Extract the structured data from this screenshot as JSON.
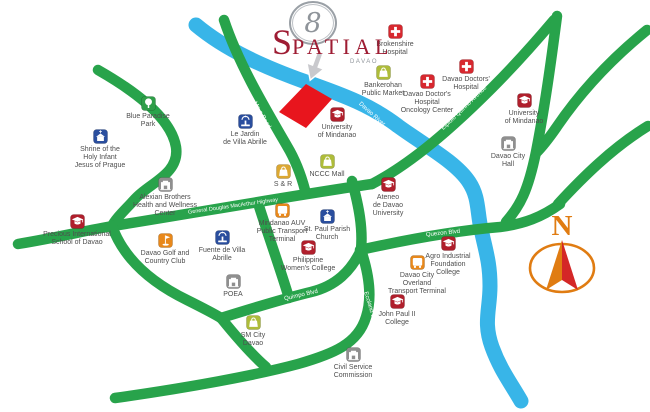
{
  "logo": {
    "mark": "8",
    "name_initial": "S",
    "name_rest": "PATIAL",
    "subtitle": "DAVAO"
  },
  "compass": {
    "north_label": "N"
  },
  "map": {
    "palette": {
      "hospital": "#d7282f",
      "school": "#b01f2c",
      "market": "#aebc3a",
      "sr": "#dca832",
      "park": "#2f9e49",
      "blue": "#2a4e9e",
      "orange": "#e8881b",
      "gov": "#8f8f8f",
      "brand_maroon": "#9e1c33",
      "logo_gray": "#8f949a",
      "compass_orange": "#e07c12",
      "compass_red": "#d42727",
      "pointer_gray": "#c9c9cd"
    },
    "colors": {
      "road": "#28a34b",
      "river": "#38b5e8",
      "site": "#e8151d",
      "road_label": "#ffffff",
      "label_text": "#4e4e4e",
      "background": "#ffffff"
    },
    "river": {
      "name": "Davao River",
      "path": "M 196,25 C 226,50 264,67 306,82 C 346,96 372,106 398,126 C 424,145 456,162 469,182 C 479,197 477,211 481,229 C 486,252 490,263 490,286 C 490,310 483,322 492,347 C 500,369 510,382 521,401"
    },
    "roads": [
      {
        "id": "left-hill-road",
        "path": "M 98,70 C 133,90 171,117 176,147 C 180,174 149,183 135,199 C 125,210 116,218 112,226"
      },
      {
        "id": "macarthur-highway",
        "path": "M 18,244 C 60,237 88,230 113,226 C 200,212 290,196 372,184"
      },
      {
        "id": "maa-road",
        "path": "M 224,20 C 238,62 262,103 287,146 C 296,161 301,175 305,190"
      },
      {
        "id": "elpidio-quirino-avenue",
        "path": "M 372,184 C 412,163 452,128 492,88 C 512,68 532,46 554,20"
      },
      {
        "id": "bajada-road",
        "path": "M 557,16 C 551,62 545,106 536,152 C 528,191 520,206 506,222"
      },
      {
        "id": "topright-corner-road",
        "path": "M 647,30 C 610,60 579,94 556,128 C 549,138 542,147 536,153"
      },
      {
        "id": "right-edge-road",
        "path": "M 648,126 C 612,148 582,178 558,204"
      },
      {
        "id": "quezon-blvd",
        "path": "M 360,250 C 405,240 452,231 500,227 C 524,224 542,217 560,204"
      },
      {
        "id": "ecoland-upper",
        "path": "M 352,181 C 359,207 363,228 361,250"
      },
      {
        "id": "quimpo-blvd-west",
        "path": "M 112,226 C 123,257 148,281 187,300 C 203,308 213,313 221,318"
      },
      {
        "id": "quimpo-blvd-east",
        "path": "M 221,318 C 250,309 282,299 311,292 C 336,286 351,271 361,250"
      },
      {
        "id": "sm-access-road",
        "path": "M 221,318 C 238,339 252,355 266,367"
      },
      {
        "id": "villa-abrille-road",
        "path": "M 258,203 C 268,235 280,268 289,298"
      },
      {
        "id": "ecoland-drive",
        "path": "M 361,250 C 370,277 372,299 366,317 C 358,344 333,354 298,364 C 257,375 187,388 115,398"
      }
    ],
    "road_labels": [
      {
        "text": "Ma-a Road",
        "x": 262,
        "y": 115,
        "rotate": 60
      },
      {
        "text": "General Douglas MacArthur Highway",
        "x": 233,
        "y": 206,
        "rotate": -8,
        "size": 5.5
      },
      {
        "text": "Davao River",
        "x": 372,
        "y": 114,
        "rotate": 42
      },
      {
        "text": "Elpidio Quirino Avenue",
        "x": 464,
        "y": 108,
        "rotate": -44
      },
      {
        "text": "Quezon Blvd",
        "x": 443,
        "y": 233,
        "rotate": -6
      },
      {
        "text": "Quimpo Blvd",
        "x": 139,
        "y": 282,
        "rotate": 47
      },
      {
        "text": "Quimpo Blvd",
        "x": 301,
        "y": 295,
        "rotate": -13
      },
      {
        "text": "Ecoland Dr",
        "x": 370,
        "y": 306,
        "rotate": 73
      }
    ],
    "site": {
      "name": "8 Spatial site",
      "polygon": "279,112 306,84 332,99 306,128"
    },
    "landmarks": [
      {
        "id": "brokenshire-hospital",
        "icon": "cross",
        "color": "hospital",
        "cx": 395,
        "cy": 31,
        "label": [
          "Brokenshire",
          "Hospital"
        ]
      },
      {
        "id": "bankerohan-public-market",
        "icon": "bag",
        "color": "market",
        "cx": 383,
        "cy": 72,
        "label": [
          "Bankerohan",
          "Public Market"
        ]
      },
      {
        "id": "davao-doctors-hospital",
        "icon": "cross",
        "color": "hospital",
        "cx": 466,
        "cy": 66,
        "label": [
          "Davao Doctors'",
          "Hospital"
        ]
      },
      {
        "id": "davao-doctors-hospital-oncology-center",
        "icon": "cross",
        "color": "hospital",
        "cx": 427,
        "cy": 81,
        "label": [
          "Davao Doctor's",
          "Hospital",
          "Oncology Center"
        ]
      },
      {
        "id": "university-of-mindanao-bajada",
        "icon": "cap",
        "color": "school",
        "cx": 524,
        "cy": 100,
        "label": [
          "University",
          "of Mindanao"
        ]
      },
      {
        "id": "davao-city-hall",
        "icon": "building",
        "color": "gov",
        "cx": 508,
        "cy": 143,
        "label": [
          "Davao City",
          "Hall"
        ]
      },
      {
        "id": "blue-paradise-park",
        "icon": "tree",
        "color": "park",
        "cx": 148,
        "cy": 103,
        "label": [
          "Blue Paradise",
          "Park"
        ]
      },
      {
        "id": "shrine-of-the-holy-infant-jesus-of-prague",
        "icon": "church",
        "color": "blue",
        "cx": 100,
        "cy": 136,
        "label": [
          "Shrine of the",
          "Holy Infant",
          "Jesus of Prague"
        ]
      },
      {
        "id": "le-jardin-de-villa-abrille",
        "icon": "fountain",
        "color": "blue",
        "cx": 245,
        "cy": 121,
        "label": [
          "Le Jardin",
          "de Villa Abrille"
        ]
      },
      {
        "id": "university-of-mindanao",
        "icon": "cap",
        "color": "school",
        "cx": 337,
        "cy": 114,
        "label": [
          "University",
          "of Mindanao"
        ]
      },
      {
        "id": "s-and-r",
        "icon": "bag",
        "color": "sr",
        "cx": 283,
        "cy": 171,
        "label": [
          "S & R"
        ]
      },
      {
        "id": "nccc-mall",
        "icon": "bag",
        "color": "market",
        "cx": 327,
        "cy": 161,
        "label": [
          "NCCC Mall"
        ]
      },
      {
        "id": "ateneo-de-davao-university",
        "icon": "cap",
        "color": "school",
        "cx": 388,
        "cy": 184,
        "label": [
          "Ateneo",
          "de Davao",
          "University"
        ]
      },
      {
        "id": "alexian-brothers-health-and-wellness-center",
        "icon": "building",
        "color": "gov",
        "cx": 165,
        "cy": 184,
        "label": [
          "Alexian Brothers",
          "Health and Wellness",
          "Center"
        ]
      },
      {
        "id": "precious-international-school-of-davao",
        "icon": "cap",
        "color": "school",
        "cx": 77,
        "cy": 221,
        "label": [
          "Precious International",
          "School of Davao"
        ]
      },
      {
        "id": "davao-golf-and-country-club",
        "icon": "golf",
        "color": "orange",
        "cx": 165,
        "cy": 240,
        "label": [
          "Davao Golf and",
          "Country Club"
        ]
      },
      {
        "id": "fuente-de-villa-abrille",
        "icon": "fountain",
        "color": "blue",
        "cx": 222,
        "cy": 237,
        "label": [
          "Fuente de Villa",
          "Abrille"
        ]
      },
      {
        "id": "mindanao-auv-public-transport-terminal",
        "icon": "bus",
        "color": "orange",
        "cx": 282,
        "cy": 210,
        "label": [
          "Mindanao AUV",
          "Public Transport",
          "Terminal"
        ]
      },
      {
        "id": "st-paul-parish-church",
        "icon": "church",
        "color": "blue",
        "cx": 327,
        "cy": 216,
        "label": [
          "St. Paul Parish",
          "Church"
        ]
      },
      {
        "id": "philippine-womens-college",
        "icon": "cap",
        "color": "school",
        "cx": 308,
        "cy": 247,
        "label": [
          "Philippine",
          "Women's College"
        ]
      },
      {
        "id": "poea",
        "icon": "building",
        "color": "gov",
        "cx": 233,
        "cy": 281,
        "label": [
          "POEA"
        ]
      },
      {
        "id": "agro-industrial-foundation-college",
        "icon": "cap",
        "color": "school",
        "cx": 448,
        "cy": 243,
        "label": [
          "Agro Industrial",
          "Foundation",
          "College"
        ]
      },
      {
        "id": "davao-city-overland-transport-terminal",
        "icon": "bus",
        "color": "orange",
        "cx": 417,
        "cy": 262,
        "label": [
          "Davao City",
          "Overland",
          "Transport Terminal"
        ]
      },
      {
        "id": "john-paul-ii-college",
        "icon": "cap",
        "color": "school",
        "cx": 397,
        "cy": 301,
        "label": [
          "John Paul II",
          "College"
        ]
      },
      {
        "id": "sm-city-davao",
        "icon": "bag",
        "color": "market",
        "cx": 253,
        "cy": 322,
        "label": [
          "SM City",
          "Davao"
        ]
      },
      {
        "id": "civil-service-commission",
        "icon": "building",
        "color": "gov",
        "cx": 353,
        "cy": 354,
        "label": [
          "Civil Service",
          "Commission"
        ]
      }
    ]
  }
}
